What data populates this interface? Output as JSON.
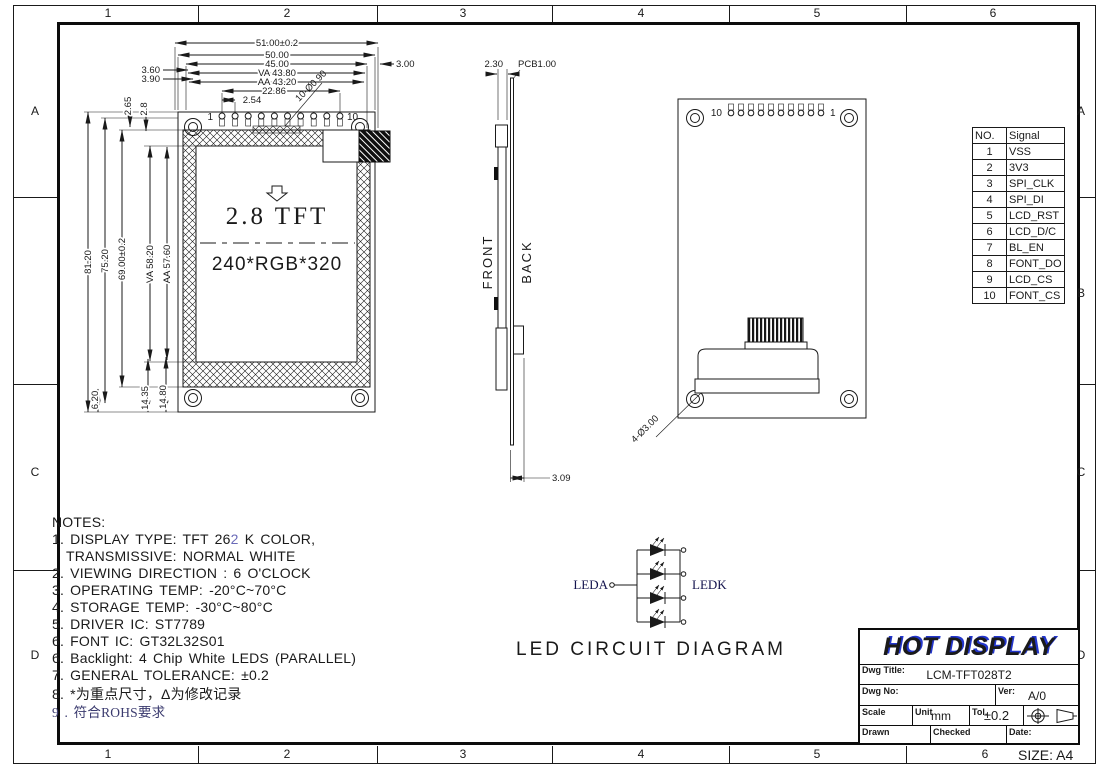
{
  "frame": {
    "top_columns": [
      "1",
      "2",
      "3",
      "4",
      "5",
      "6"
    ],
    "bottom_columns": [
      "1",
      "2",
      "3",
      "4",
      "5",
      "6"
    ],
    "left_rows": [
      "A",
      "C",
      "D"
    ],
    "right_rows": [
      "A",
      "B",
      "C",
      "D"
    ],
    "size_label": "SIZE: A4"
  },
  "front_view": {
    "screen_label": "2.8 TFT",
    "resolution": "240*RGB*320",
    "pin_first": "1",
    "pin_last": "10",
    "pin_hole_callout": "10-Ø0.90",
    "dims": {
      "w_total": "51.00±0.2",
      "w_outline": "50.00",
      "w_45": "45.00",
      "w_va": "VA 43.80",
      "w_aa": "AA 43.20",
      "pin_span": "22.86",
      "pin_pitch": "2.54",
      "edge_360": "3.60",
      "edge_390": "3.90",
      "edge_right": "3.00",
      "h_total": "81.20",
      "h_7520": "75.20",
      "h_6900": "69.00±0.2",
      "h_va": "VA 58.20",
      "h_aa": "AA 57.60",
      "top_265": "2.65",
      "top_28": "2.8",
      "bot_620": "6.20",
      "bot_1435": "14.35",
      "bot_1480": "14.80"
    }
  },
  "side_view": {
    "front_label": "FRONT",
    "back_label": "BACK",
    "dims": {
      "thickness": "2.30",
      "pcb": "PCB1.00",
      "bottom": "3.09"
    }
  },
  "back_view": {
    "pin_first": "10",
    "pin_last": "1",
    "hole_callout": "4-Ø3.00"
  },
  "signal_table": {
    "headers": [
      "NO.",
      "Signal"
    ],
    "rows": [
      {
        "no": "1",
        "signal": "VSS"
      },
      {
        "no": "2",
        "signal": "3V3"
      },
      {
        "no": "3",
        "signal": "SPI_CLK"
      },
      {
        "no": "4",
        "signal": "SPI_DI"
      },
      {
        "no": "5",
        "signal": "LCD_RST"
      },
      {
        "no": "6",
        "signal": "LCD_D/C"
      },
      {
        "no": "7",
        "signal": "BL_EN"
      },
      {
        "no": "8",
        "signal": "FONT_DO"
      },
      {
        "no": "9",
        "signal": "LCD_CS"
      },
      {
        "no": "10",
        "signal": "FONT_CS"
      }
    ]
  },
  "notes": {
    "title": "NOTES:",
    "line1_prefix": "1. DISPLAY TYPE: TFT 26",
    "line1_highlight": "2",
    "line1_suffix": " K COLOR,",
    "line1_cont": "TRANSMISSIVE: NORMAL WHITE",
    "items": [
      "2. VIEWING DIRECTION : 6 O'CLOCK",
      "3. OPERATING TEMP: -20°C~70°C",
      "4. STORAGE TEMP: -30°C~80°C",
      "5. DRIVER IC: ST7789",
      "6. FONT IC: GT32L32S01",
      "6. Backlight: 4 Chip White LEDS (PARALLEL)",
      "7. GENERAL TOLERANCE: ±0.2",
      "8. *为重点尺寸，Δ为修改记录"
    ],
    "rohs_note": "9 . 符合ROHS要求"
  },
  "led_circuit": {
    "anode_label": "LEDA",
    "cathode_label": "LEDK",
    "caption": "LED CIRCUIT DIAGRAM"
  },
  "title_block": {
    "company": "HOT DISPLAY",
    "dwg_title_label": "Dwg Title:",
    "dwg_title_value": "LCM-TFT028T2",
    "dwg_no_label": "Dwg No:",
    "ver_label": "Ver:",
    "ver_value": "A/0",
    "scale_label": "Scale",
    "unit_label": "Unit",
    "unit_value": "mm",
    "tol_label": "Tol.",
    "tol_value": "±0.2",
    "drawn_label": "Drawn",
    "checked_label": "Checked",
    "date_label": "Date:"
  },
  "colors": {
    "ink": "#1a1a1a",
    "brand_shadow_blue": "#2336cc",
    "note_highlight_blue": "#6a6ab8",
    "rohs_note_color": "#3a3a6e"
  }
}
